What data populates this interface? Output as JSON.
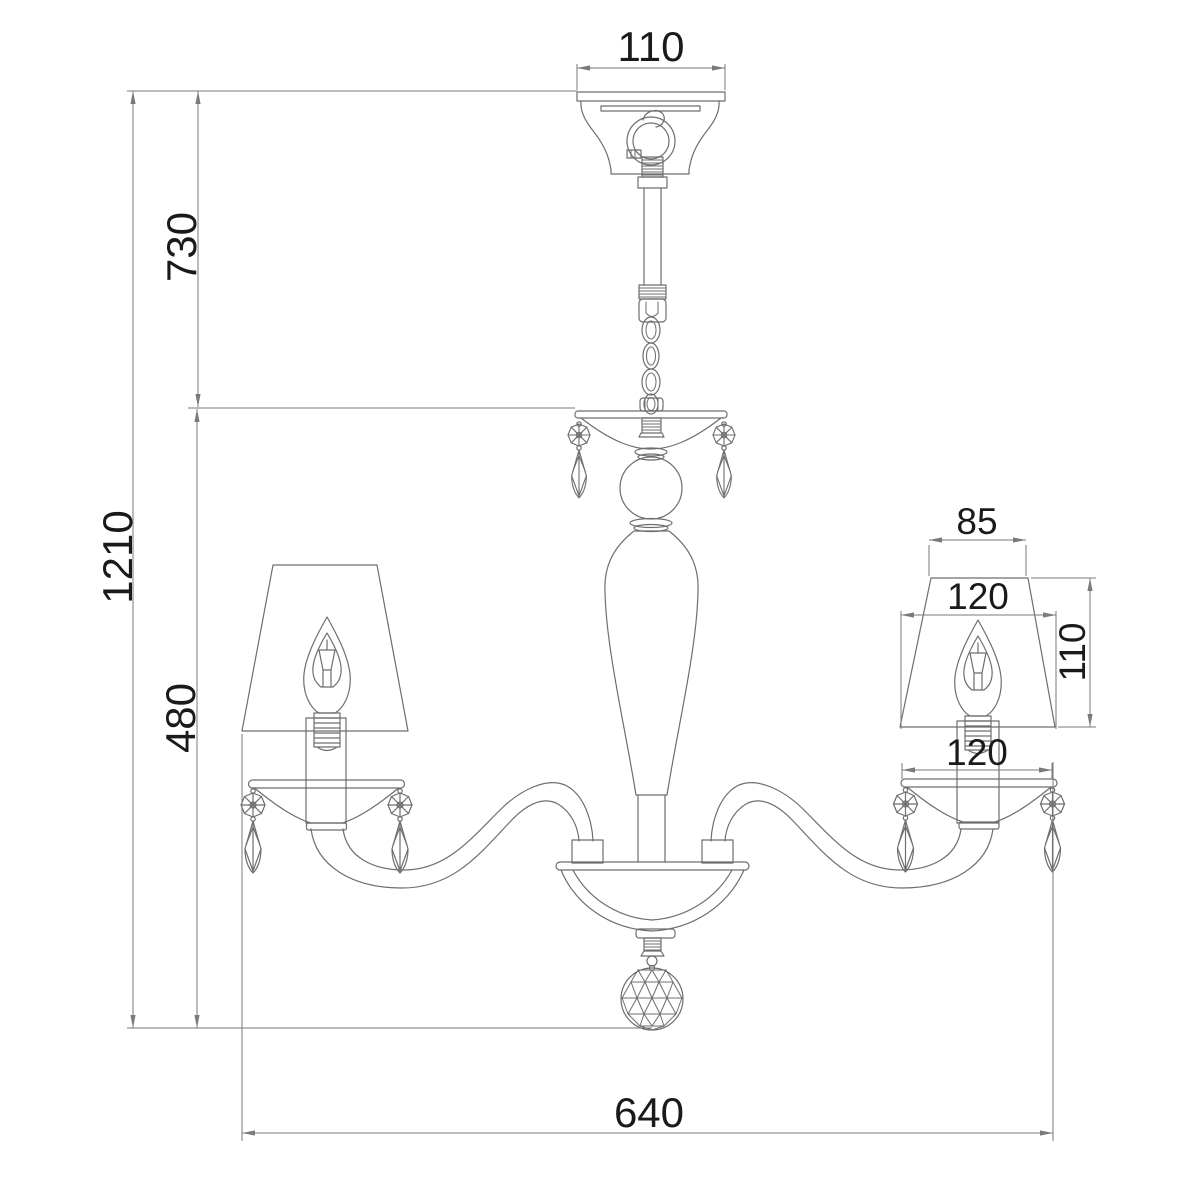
{
  "colors": {
    "background": "#ffffff",
    "line": "#6e6e6e",
    "dimline": "#7a7a7a",
    "text": "#1a1a1a"
  },
  "dimensions": {
    "canopy_width": "110",
    "hanging_height": "730",
    "total_height": "1210",
    "body_height": "480",
    "shade_top_width": "85",
    "shade_bottom_width": "120",
    "shade_height": "110",
    "arm_cup_width": "120",
    "total_width": "640"
  }
}
